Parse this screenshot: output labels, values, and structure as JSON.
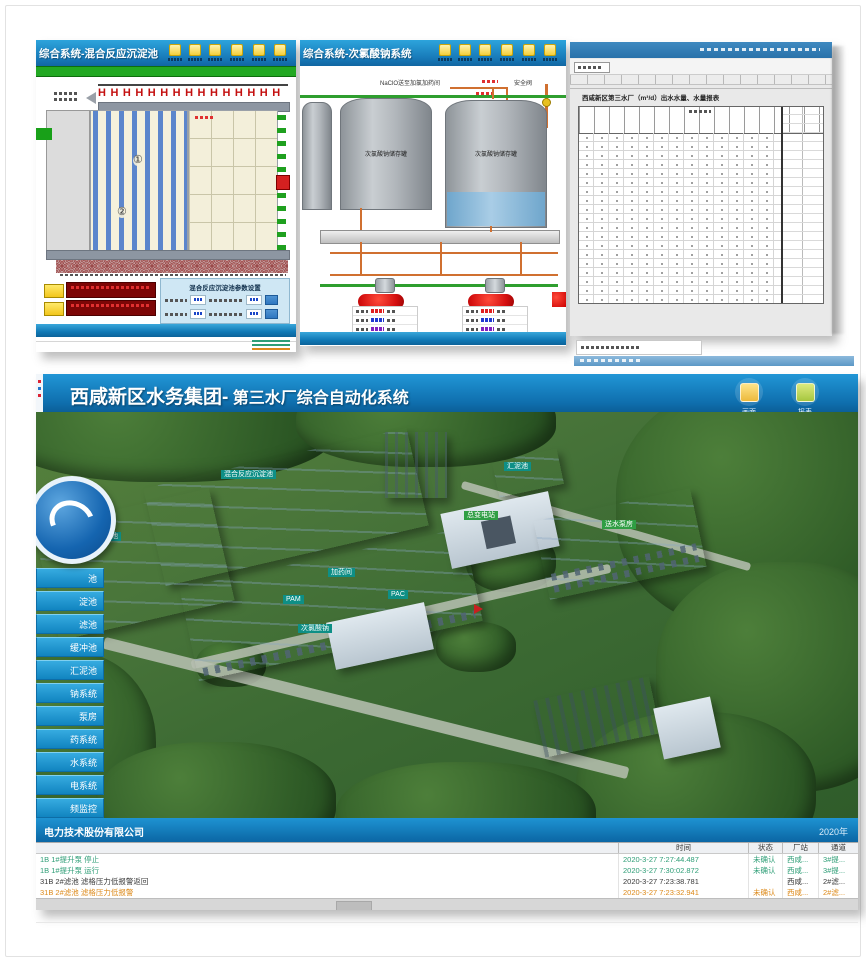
{
  "colors": {
    "titlebar_blue": "#1779b8",
    "scada_green_band": "#22a822",
    "sidebar_blue": "#1b9ad6",
    "pipe_orange": "#d07030",
    "alarm_orange": "#dd8a1a",
    "ok_green": "#2f9e77",
    "alarm_red": "#d40f0f"
  },
  "screen_a": {
    "title": "综合系统-混合反应沉淀池",
    "mixer_row": "HHHHHHHHHHHHHHH",
    "mark1": "①",
    "mark2": "②",
    "panel_title": "混合反应沉淀池参数设置"
  },
  "screen_b": {
    "title": "综合系统-次氯酸钠系统",
    "pipe_label": "NaClO送至加氯加药间",
    "safety_valve_label": "安全阀",
    "tank1_label": "次氯酸钠储存罐",
    "tank2_label": "次氯酸钠储存罐"
  },
  "screen_c": {
    "report_title": "西咸新区第三水厂（m³/d）出水水量、水量报表"
  },
  "screen_d": {
    "title_main": "西咸新区水务集团-",
    "title_sub": " 第三水厂综合自动化系统",
    "btn1_label": "画面",
    "btn2_label": "报表",
    "sidebar": [
      "池",
      "淀池",
      "滤池",
      "缓冲池",
      "汇泥池",
      "钠系统",
      "泵房",
      "药系统",
      "水系统",
      "电系统",
      "频监控",
      "织机构"
    ],
    "buildings": {
      "hunhe": "混合反应沉淀池",
      "shalv": "砂滤池",
      "huini": "汇泥池",
      "jiayao": "加药间",
      "pam": "PAM",
      "pac": "PAC",
      "cilv": "次氯酸钠",
      "zongbian": "总变电站",
      "songshui": "送水泵房"
    },
    "footer_left": "电力技术股份有限公司",
    "footer_right": "2020年",
    "events": {
      "headers": [
        "时间",
        "状态",
        "厂站",
        "通道"
      ],
      "rows": [
        {
          "msg": "1B 1#提升泵 停止",
          "time": "2020-3-27 7:27:44.487",
          "status": "未确认",
          "station": "西咸...",
          "channel": "3#提..."
        },
        {
          "msg": "1B 1#提升泵 运行",
          "time": "2020-3-27 7:30:02.872",
          "status": "未确认",
          "station": "西咸...",
          "channel": "3#提..."
        },
        {
          "msg": "31B 2#滤池 滤格压力低报警返回",
          "time": "2020-3-27 7:23:38.781",
          "status": "",
          "station": "西咸...",
          "channel": "2#滤..."
        },
        {
          "msg": "31B 2#滤池 滤格压力低报警",
          "time": "2020-3-27 7:23:32.941",
          "status": "未确认",
          "station": "西咸...",
          "channel": "2#滤..."
        }
      ]
    }
  }
}
